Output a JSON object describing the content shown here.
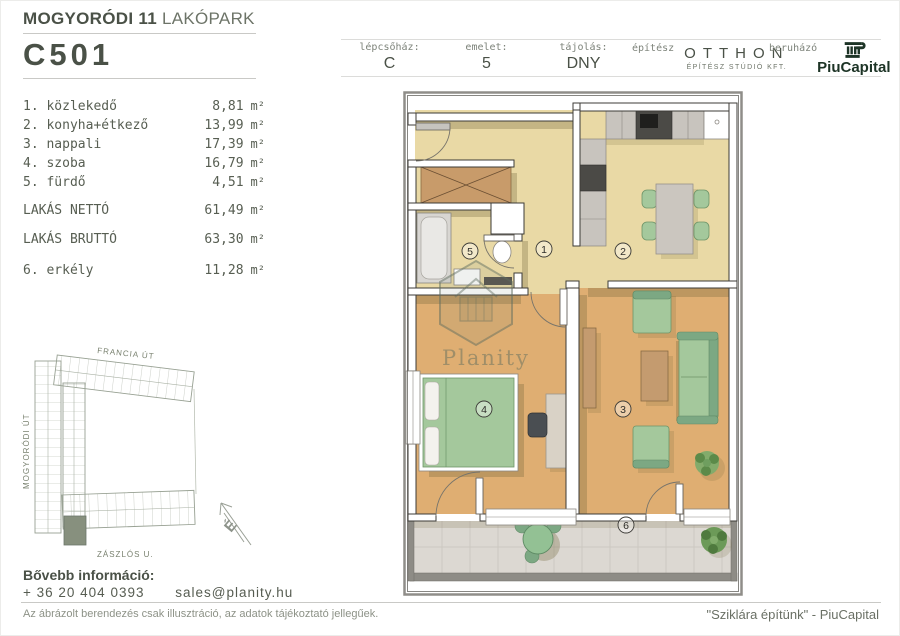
{
  "page": {
    "title_bold": "MOGYORÓDI 11",
    "title_light": "LAKÓPARK",
    "unit_id": "C501"
  },
  "header_fields": [
    {
      "label": "lépcsőház:",
      "value": "C"
    },
    {
      "label": "emelet:",
      "value": "5"
    },
    {
      "label": "tájolás:",
      "value": "DNY"
    }
  ],
  "architect": {
    "label": "építész",
    "name": "OTTHON",
    "subtitle": "ÉPÍTÉSZ STÚDIÓ KFT."
  },
  "developer": {
    "label": "beruházó",
    "name": "PiuCapital"
  },
  "rooms": [
    {
      "label": "1. közlekedő",
      "area": "8,81"
    },
    {
      "label": "2. konyha+étkező",
      "area": "13,99"
    },
    {
      "label": "3. nappali",
      "area": "17,39"
    },
    {
      "label": "4. szoba",
      "area": "16,79"
    },
    {
      "label": "5. fürdő",
      "area": "4,51"
    }
  ],
  "totals": [
    {
      "label": "LAKÁS NETTÓ",
      "area": "61,49"
    },
    {
      "label": "LAKÁS BRUTTÓ",
      "area": "63,30"
    }
  ],
  "balcony_row": {
    "label": "6. erkély",
    "area": "11,28"
  },
  "unit_suffix": "m²",
  "floor_plan": {
    "watermark": "Planity",
    "room_labels": [
      "1",
      "2",
      "3",
      "4",
      "5",
      "6"
    ]
  },
  "site_plan": {
    "street_top": "FRANCIA ÚT",
    "street_left": "MOGYORÓDI ÚT",
    "street_bottom": "ZÁSZLÓS U.",
    "north": "É"
  },
  "footer": {
    "info_label": "Bővebb információ:",
    "phone": "+ 36 20 404 0393",
    "email": "sales@planity.hu",
    "disclaimer": "Az ábrázolt berendezés csak illusztráció, az adatok tájékoztató jellegűek.",
    "slogan": "\"Sziklára építünk\" - PiuCapital"
  },
  "colors": {
    "ink": "#4a5147",
    "ink-soft": "#6d7468",
    "rule": "#c9c9c6",
    "mono-text": "#575e52",
    "brand-green": "#1d3426",
    "floor-pale": "#e9d9a5",
    "floor-wood": "#dfae72",
    "furn-green": "#a4c89c",
    "furn-green-deep": "#7ca883",
    "wood-tan": "#c89b6a",
    "wall-line": "#3c3b37",
    "shadow": "#6f6239",
    "counter": "#c8c4be",
    "appliance": "#4b4a46",
    "tile": "#dcd8d2",
    "tile-line": "#c7c3bc",
    "balcony-wall": "#8e8c86",
    "site-line": "#97a092"
  }
}
